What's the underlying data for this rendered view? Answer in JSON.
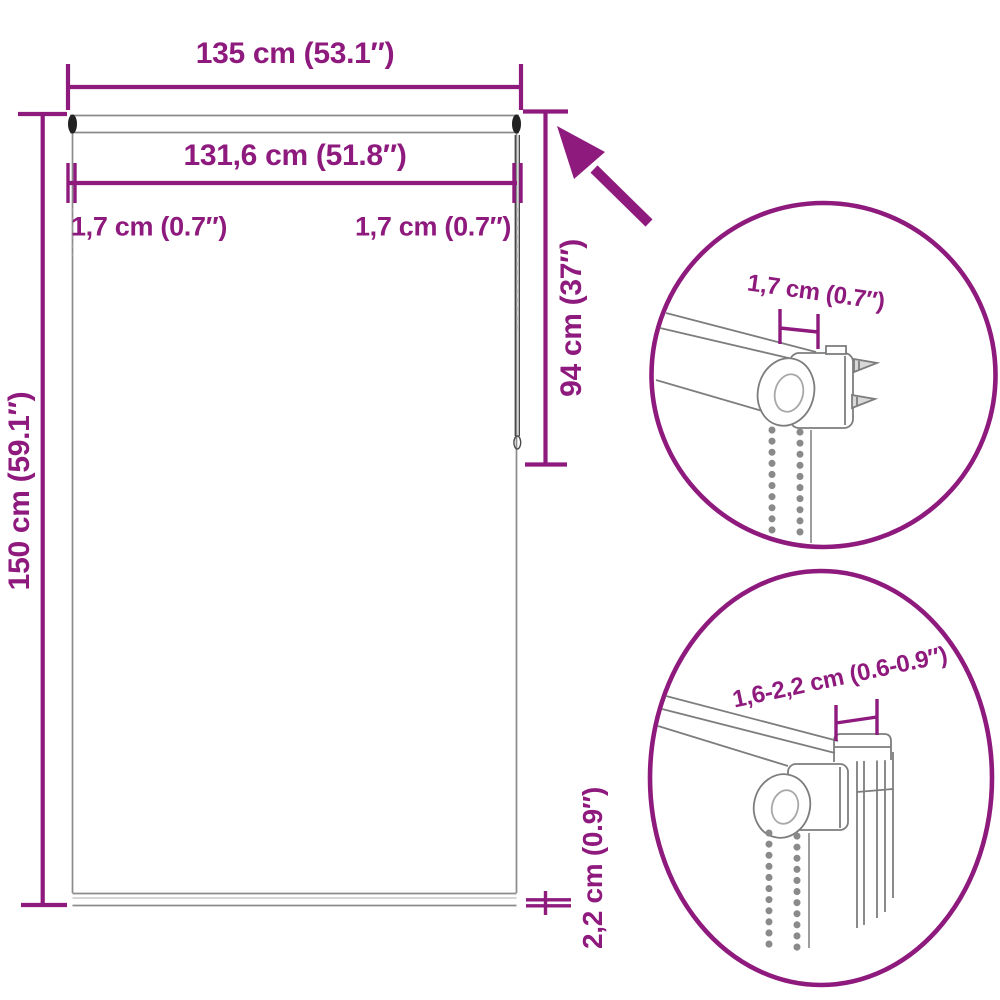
{
  "figure": {
    "type": "product-dimension-diagram",
    "subject": "roller blind with bead chain and clamp brackets"
  },
  "colors": {
    "accent": "#8e1a7e",
    "drawing_gray": "#8b8b8b",
    "end_cap_dark": "#222222",
    "background": "#ffffff"
  },
  "main_diagram": {
    "width_total": "135 cm (53.1″)",
    "fabric_width": "131,6 cm (51.8″)",
    "side_gap_left": "1,7 cm (0.7″)",
    "side_gap_right": "1,7 cm (0.7″)",
    "height_total": "150 cm (59.1″)",
    "chain_length": "94 cm (37″)",
    "bottom_bar_height": "2,2 cm (0.9″)"
  },
  "detail_top": {
    "bracket_depth": "1,7 cm (0.7″)"
  },
  "detail_bottom": {
    "clamp_range": "1,6-2,2 cm (0.6-0.9″)"
  }
}
